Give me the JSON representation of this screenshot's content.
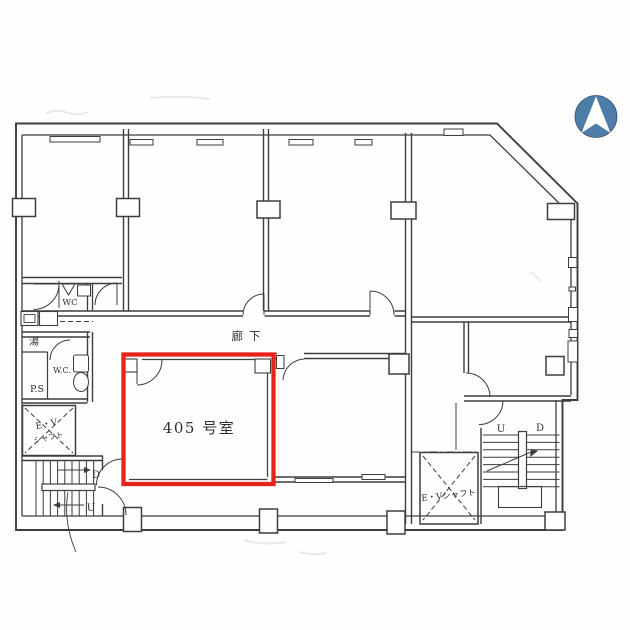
{
  "colors": {
    "paper": "#fefefe",
    "wall": "#3d3d3d",
    "highlight_red": "#e8231c",
    "compass_blue": "#4d7ca6",
    "ink": "#2f2f2f",
    "ink_blue": "#2e4f8e"
  },
  "labels": {
    "room405": "405 号室",
    "corridor": "廊下",
    "wc_upper": "WC",
    "wc_lower": "W.C.",
    "pipe_shaft": "P.S",
    "hot_water": "湯",
    "ev_shaft_left_1": "E・V",
    "ev_shaft_left_2": "シャフト",
    "ev_shaft_right": "E・Vシャフト",
    "stairs_left_down": "D",
    "stairs_left_up": "U",
    "stairs_right_up": "U",
    "stairs_right_down": "D"
  }
}
